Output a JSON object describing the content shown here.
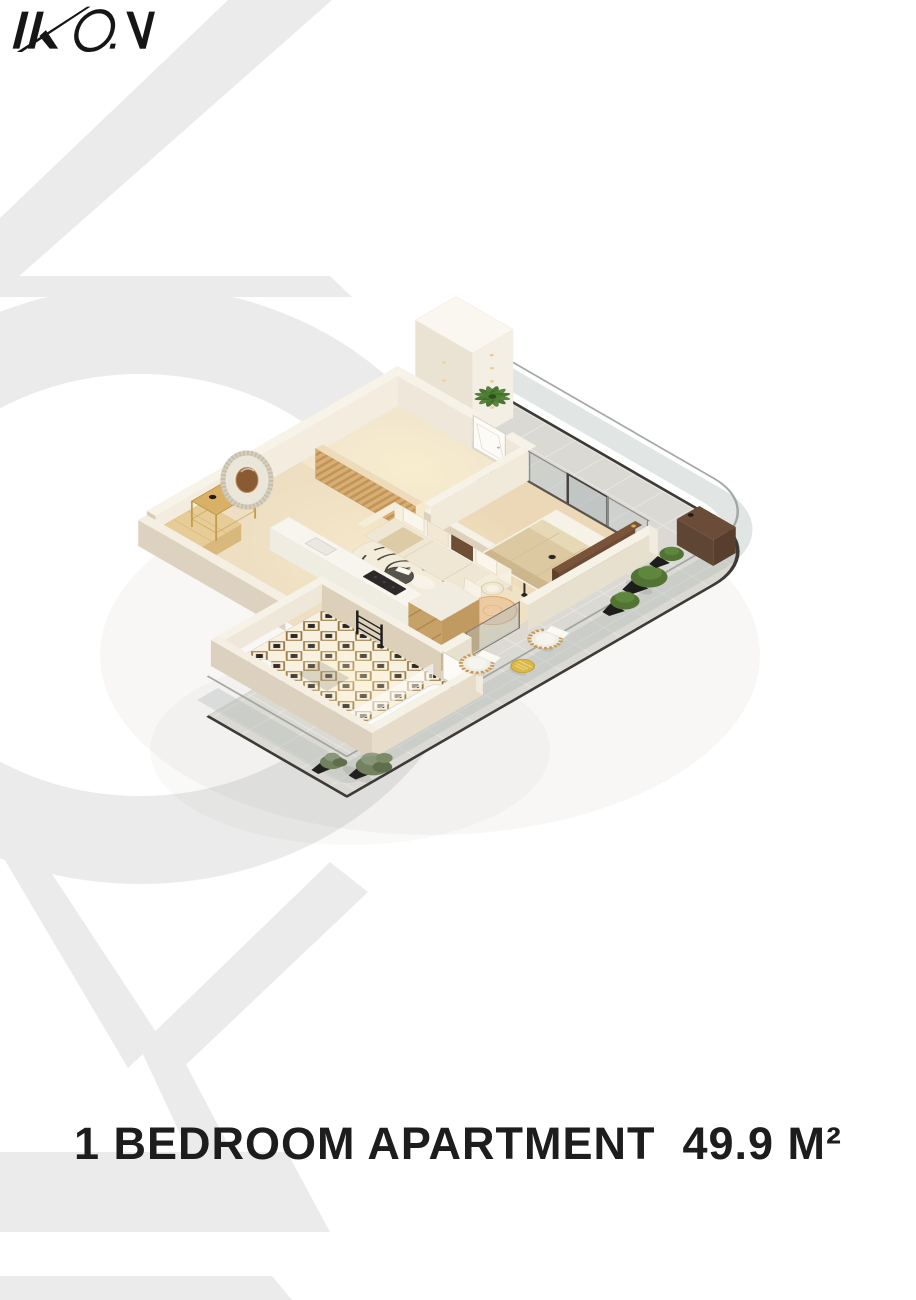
{
  "page": {
    "background": "#ffffff",
    "width": 916,
    "height": 1300
  },
  "logo": {
    "text": "IKON",
    "color": "#161616"
  },
  "title": {
    "text": "1 BEDROOM APARTMENT  49.9 M²",
    "color": "#1d1d1d"
  },
  "watermark": {
    "color": "#ebebeb"
  },
  "palette": {
    "wall_top": "#f7f2e7",
    "wall_face": "#e8e0cf",
    "floor_beige": "#eedfc2",
    "bedroom_floor": "#ecd8b6",
    "terrace_tile": "#dbd9d3",
    "balustrade": "#3c3a36",
    "wood": "#c9a46c",
    "sofa_cream": "#efe7d3",
    "duvet": "#dcc9a2",
    "plant_green": "#517434",
    "olive_green": "#74815f",
    "pot_black": "#1d1d1c",
    "gold": "#d8b166"
  }
}
